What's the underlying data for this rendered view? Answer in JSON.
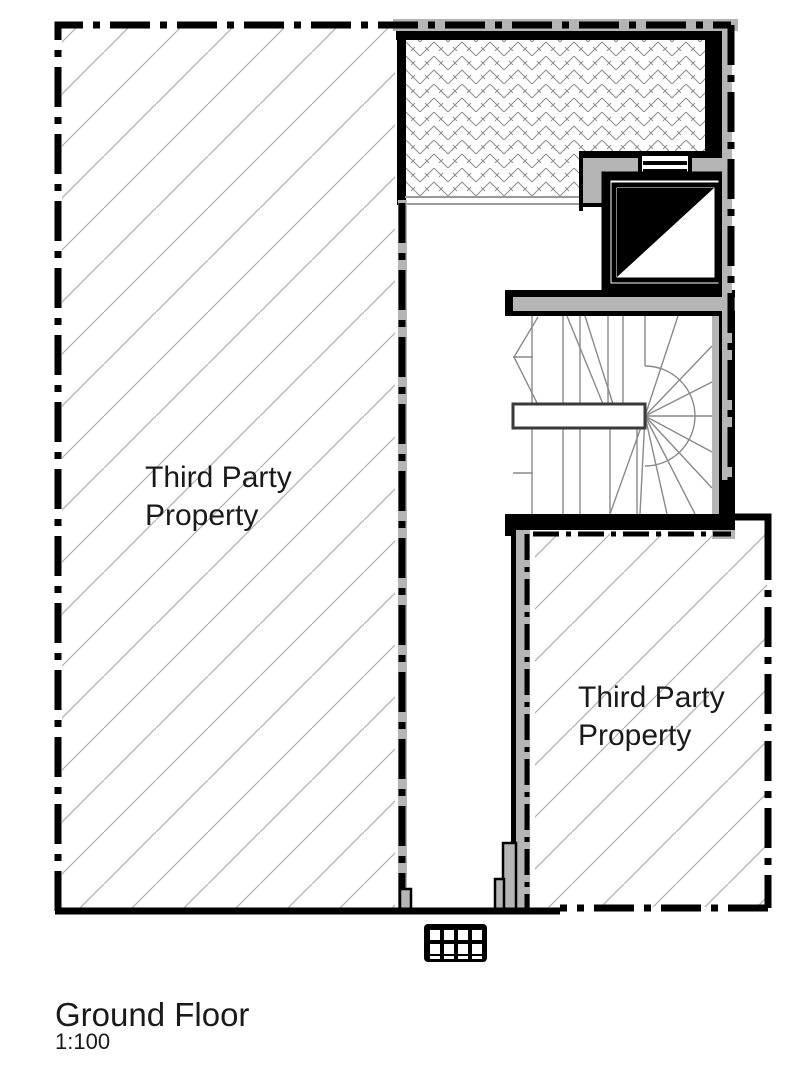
{
  "plan": {
    "title": "Ground Floor",
    "scale": "1:100",
    "left_property": {
      "line1": "Third Party",
      "line2": "Property"
    },
    "right_property": {
      "line1": "Third Party",
      "line2": "Property"
    }
  },
  "colors": {
    "wall_gray": "#b5b5b5",
    "hatch_gray": "#b3b3b3",
    "herringbone_gray": "#8c8c8c",
    "stair_line_gray": "#8a8a8a",
    "ink_black": "#000000",
    "paper_white": "#ffffff",
    "text_color": "#1a1a1a"
  },
  "symbols": {
    "lift_void_symbol": "diagonal-split-square",
    "drain_grate": "grate-grid",
    "property_line_style": "dash-dot"
  }
}
